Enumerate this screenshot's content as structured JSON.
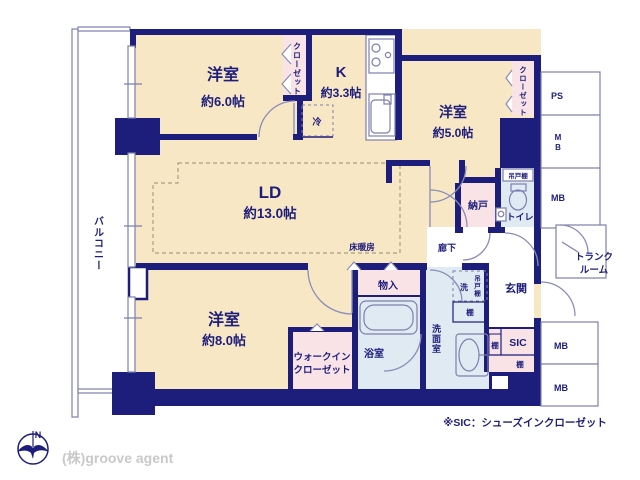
{
  "plan_type": "floorplan",
  "labels": {
    "balcony": "バルコニー",
    "bedroom1_name": "洋室",
    "bedroom1_size": "約6.0帖",
    "closet1": "クローゼット",
    "kitchen_name": "K",
    "kitchen_size": "約3.3帖",
    "fridge": "冷",
    "bedroom2_name": "洋室",
    "bedroom2_size": "約5.0帖",
    "closet2": "クローゼット",
    "ld_name": "LD",
    "ld_size": "約13.0帖",
    "floor_heating": "床暖房",
    "bedroom3_name": "洋室",
    "bedroom3_size": "約8.0帖",
    "wic_line1": "ウォークイン",
    "wic_line2": "クローゼット",
    "storage": "物入",
    "bath": "浴室",
    "washroom": "洗面室",
    "laundry": "洗",
    "hanging_cabinet_wash": "吊戸棚",
    "shelf_wash": "棚",
    "nando": "納戸",
    "hanging_cabinet_toilet": "吊戸棚",
    "toilet": "トイレ",
    "hall": "廊下",
    "genkan": "玄関",
    "sic": "SIC",
    "shelf_sic_left": "棚",
    "shelf_sic_bottom": "棚",
    "ps": "PS",
    "mb_top": "MB",
    "mb_mid": "MB",
    "mb_bottom1": "MB",
    "mb_bottom2": "MB",
    "trunk_line1": "トランク",
    "trunk_line2": "ルーム",
    "note": "※SIC：シューズインクローゼット",
    "compass_n": "N",
    "credit": "(株)groove agent"
  },
  "colors": {
    "wall": "#1d1d7b",
    "room": "#f7e7c5",
    "closet_pink": "#f9e3e6",
    "wet_blue": "#dfeaf3",
    "fixture_outline": "#7d7fae",
    "credit_text": "#c9c9c9"
  }
}
